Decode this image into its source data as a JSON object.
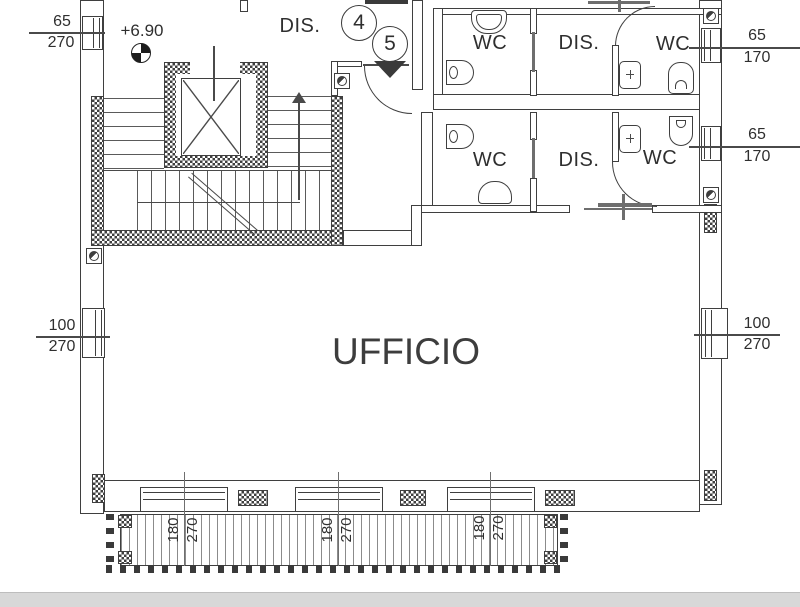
{
  "plan": {
    "title": "UFFICIO",
    "hall_label": "DIS.",
    "level_label": "+6.90",
    "rooms": {
      "wc1": "WC",
      "dis1": "DIS.",
      "wc2": "WC",
      "wc3": "WC",
      "dis2": "DIS.",
      "wc4": "WC"
    },
    "markers": {
      "m4": "4",
      "m5": "5"
    },
    "dims": {
      "left_upper": {
        "w": "65",
        "h": "270"
      },
      "left_lower": {
        "w": "100",
        "h": "270"
      },
      "right_upper": {
        "w": "65",
        "h": "170"
      },
      "right_middle": {
        "w": "65",
        "h": "170"
      },
      "right_lower": {
        "w": "100",
        "h": "270"
      },
      "balcony": [
        {
          "w": "180",
          "h": "270"
        },
        {
          "w": "180",
          "h": "270"
        },
        {
          "w": "180",
          "h": "270"
        }
      ]
    },
    "colors": {
      "line": "#3f3f3f",
      "text": "#2f2f2f",
      "paper": "#ffffff",
      "scan_edge": "#d8d8d8"
    }
  }
}
